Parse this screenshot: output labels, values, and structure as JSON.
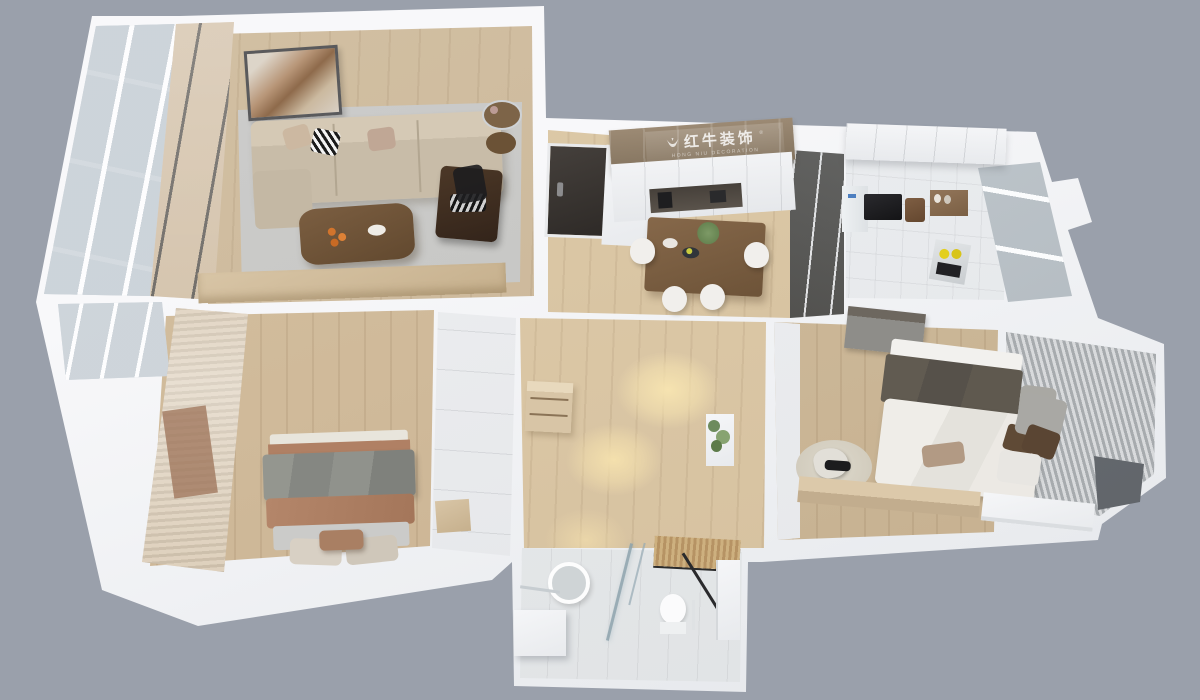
{
  "meta": {
    "scene": "3d-apartment-floorplan-render",
    "view": "isometric-top-down-cutaway"
  },
  "watermark": {
    "brand": "红牛装饰",
    "registered": "®",
    "sub": "HONG NIU DECORATION",
    "logo": "bull-icon"
  },
  "palette": {
    "background": "#9aa0ab",
    "walls": "#f4f5f7",
    "wood_floor": "#cdb394",
    "hall_wood": "#dbc7a6",
    "warm_light": "#f3e0b4",
    "living_rug": "#c6c6c3",
    "sofa": "#c8bca8",
    "walnut_table": "#6f543a",
    "dark_armchair": "#3f2e20",
    "terracotta_bedding": "#ae8065",
    "gray_bedding": "#8b8d89",
    "dark_blanket": "#5c564c",
    "white_duvet": "#ebe9e4",
    "tile": "#e8eaec",
    "entry_door": "#3b3633",
    "cabinet_brown": "#95816b",
    "glass_partition": "#44423f",
    "curtain_wood": "#c7b293",
    "plant_green": "#6d8b5d",
    "lemons": "#ddc91f"
  },
  "rooms": [
    {
      "id": "balcony-left",
      "features": [
        "floor-to-ceiling-glazing",
        "window-grid"
      ]
    },
    {
      "id": "living-room",
      "features": [
        "wall-art",
        "three-seat-sofa",
        "throw-pillows",
        "area-rug",
        "coffee-table",
        "fruit-plate",
        "dark-armchair",
        "side-table",
        "tv-console",
        "desk-chair"
      ]
    },
    {
      "id": "entry-hall",
      "features": [
        "entry-door",
        "smart-lock",
        "shoe-cabinet"
      ]
    },
    {
      "id": "dining-area",
      "features": [
        "sideboard-upper-cabinets",
        "coffee-station-niche",
        "dining-table",
        "four-chairs",
        "plant-centerpiece",
        "plates"
      ]
    },
    {
      "id": "kitchen",
      "features": [
        "fridge",
        "microwave",
        "bread-bin",
        "spice-shelf",
        "cooktop-with-lemons",
        "window",
        "upper-cabinets"
      ]
    },
    {
      "id": "hallway",
      "features": [
        "wood-cabinet",
        "wall-plant",
        "recessed-light-pools"
      ]
    },
    {
      "id": "master-bedroom",
      "features": [
        "double-bed",
        "gray-throw",
        "terracotta-blanket",
        "pillows",
        "slat-curtain-wall",
        "sheer-curtain",
        "desk-nook",
        "wardrobe"
      ]
    },
    {
      "id": "second-bedroom",
      "features": [
        "bed-dark-blanket",
        "white-duvet",
        "pillows",
        "office-chair",
        "round-rug",
        "desk",
        "ceiling-panel",
        "bay-window-blinds",
        "window-cushions"
      ]
    },
    {
      "id": "bathroom",
      "features": [
        "round-mirror",
        "vanity",
        "glass-shower-screen",
        "toilet",
        "wood-slat-ceiling",
        "towel-rail"
      ]
    }
  ]
}
